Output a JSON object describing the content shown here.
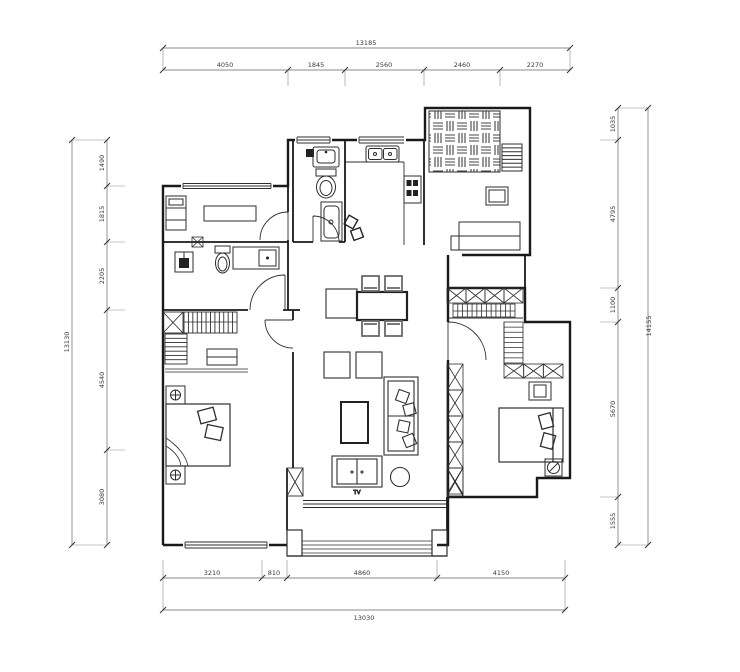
{
  "drawing": {
    "type": "apartment-floor-plan",
    "background": "#ffffff",
    "wall_color": "#1a1a1a",
    "furniture_color": "#2e2e2e",
    "dimension_color": "#555555"
  },
  "dimensions": {
    "top": {
      "segments": [
        "4050",
        "1845",
        "2560",
        "2460",
        "2270"
      ],
      "total": "13185"
    },
    "bottom": {
      "segments": [
        "3210",
        "810",
        "4860",
        "4150"
      ],
      "total": "13030"
    },
    "left": {
      "segments": [
        "1490",
        "1815",
        "2205",
        "4540",
        "3080"
      ],
      "total": "13130"
    },
    "right": {
      "segments": [
        "1035",
        "4795",
        "1100",
        "5670",
        "1555"
      ],
      "total": "14155"
    }
  },
  "labels": {
    "tv": "TV"
  }
}
